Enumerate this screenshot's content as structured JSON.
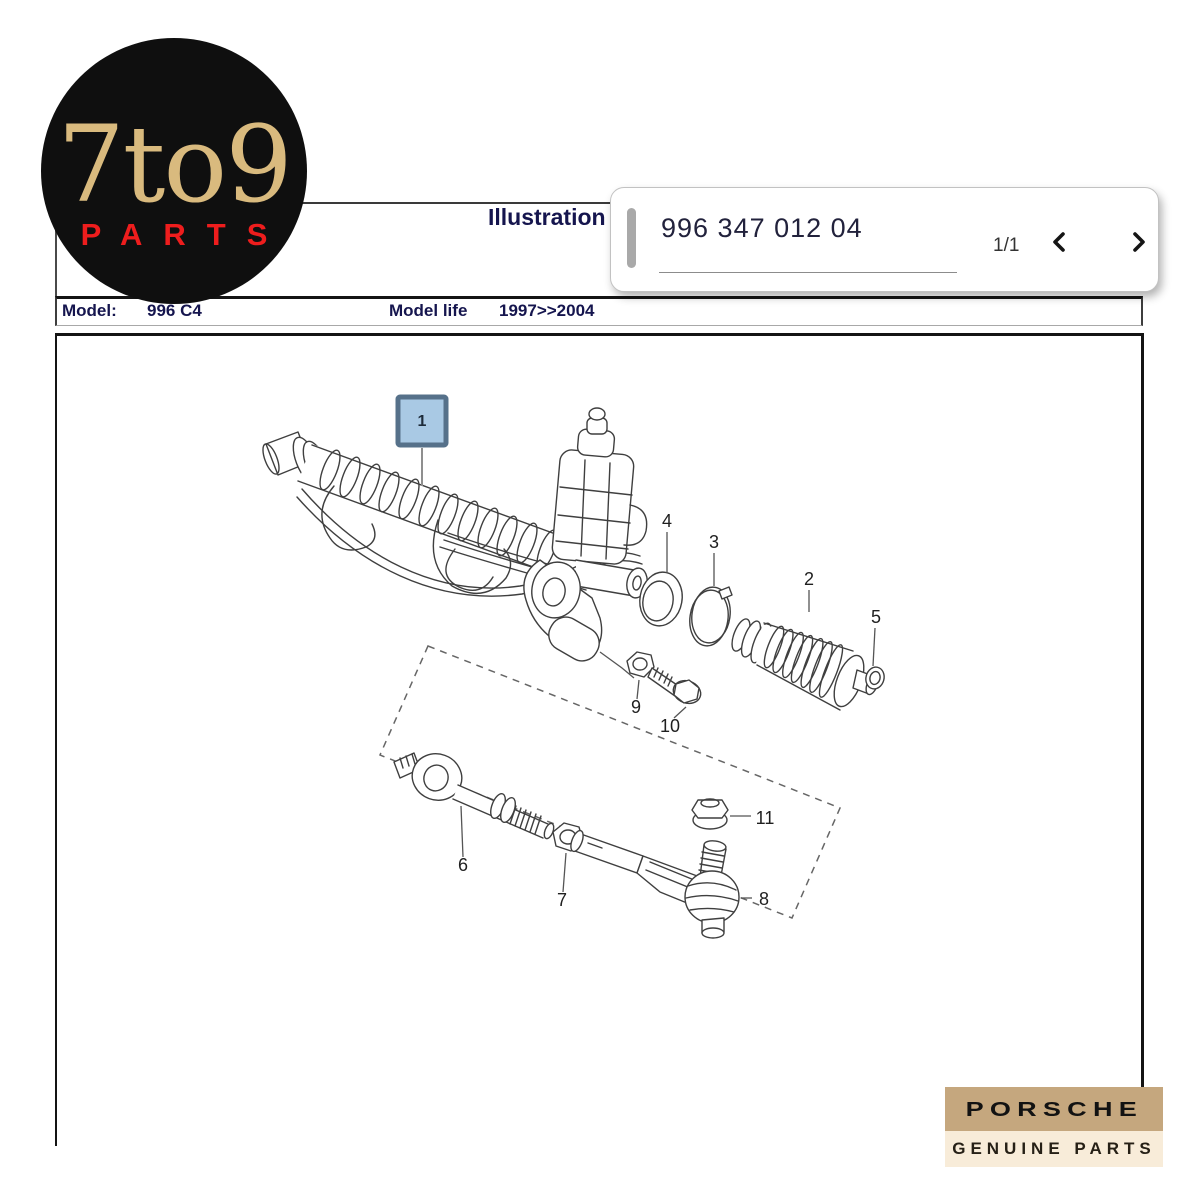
{
  "logo": {
    "title": "7to9",
    "subtitle": "PARTS"
  },
  "header": {
    "title": "Illustration"
  },
  "model_row": {
    "label": "Model:",
    "value_fragment": "996 C4",
    "life_label": "Model life",
    "life_value": "1997>>2004"
  },
  "search": {
    "part_number": "996 347 012 04",
    "page_indicator": "1/1",
    "prev_icon": "chevron-left",
    "next_icon": "chevron-right"
  },
  "diagram": {
    "part_labels": [
      "1",
      "2",
      "3",
      "4",
      "5",
      "6",
      "7",
      "8",
      "9",
      "10",
      "11"
    ],
    "highlight_fill": "#a9c9e4",
    "highlight_border": "#56718a"
  },
  "badge": {
    "brand": "PORSCHE",
    "subtitle": "GENUINE PARTS",
    "brand_bg": "#c5a77e",
    "subtitle_bg": "#f8ecd9"
  },
  "colors": {
    "logo_gold": "#d9ba7e",
    "logo_red": "#ee1d1d",
    "title_navy": "#15154e",
    "line_dark": "#141414"
  }
}
